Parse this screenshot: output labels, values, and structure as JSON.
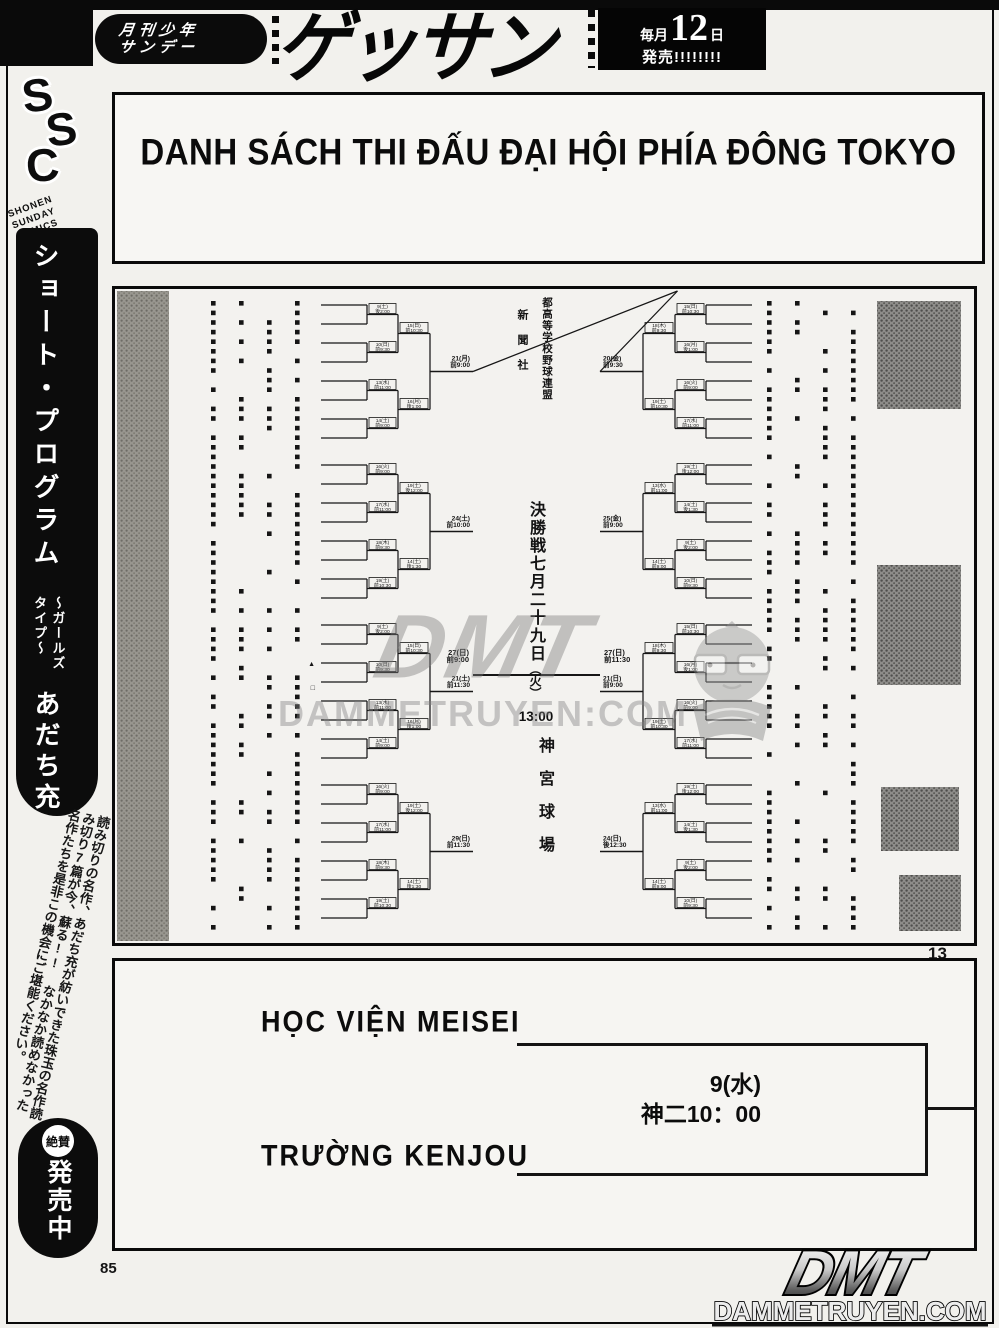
{
  "banner": {
    "magazine_line1": "月刊少年",
    "magazine_line2": "サンデー",
    "logo": "ゲッサン",
    "release_prefix": "毎月",
    "release_day": "12",
    "release_day_suffix": "日",
    "release_suffix": "発売!!!!!!!!"
  },
  "sidebar": {
    "logo_letters": [
      "S",
      "S",
      "C"
    ],
    "logo_caption": "SHONEN SUNDAY COMICS",
    "series_title": "ショート・プログラム",
    "series_subtitle": "〜ガールズタイプ〜",
    "author": "あだち充",
    "blurb": "読み切りの名作、あだち充が紡いできた珠玉の名作読み切り7篇が今、蘇る!! なかなか読めなかった名作たちを是非この機会にご堪能ください。",
    "badge": "絶賛",
    "on_sale": "発売中",
    "page_number": "85"
  },
  "title_box": {
    "title": "DANH SÁCH THI ĐẤU ĐẠI HỘI PHÍA ĐÔNG TOKYO"
  },
  "bracket": {
    "org_column_a": "新聞社",
    "org_column_b": "都高等学校野球連盟",
    "final_text": "決勝戦七月二十九日",
    "final_day": "（火）",
    "final_time": "13:00",
    "venue": "神宮球場",
    "page_number": "13",
    "left_semi_label": "27(日)\n前9:00",
    "right_semi_label": "27(日)\n前11:30",
    "left_tap_labels": [
      "21(月)\n前9:00",
      "24(土)\n前10:00",
      "21(土)\n前11:30",
      "29(日)\n前11:30"
    ],
    "right_tap_labels": [
      "20(金)\n前9:30",
      "25(金)\n前9:00",
      "21(日)\n前9:00",
      "24(日)\n後12:30"
    ],
    "small_label_pool": [
      "9(土)\n後2:00",
      "10(日)\n前9:30",
      "13(水)\n前11:00",
      "14(土)\n前9:00",
      "15(日)\n前10:30",
      "16(月)\n後1:00",
      "16(火)\n前9:00",
      "17(水)\n前11:00",
      "18(木)\n前9:30",
      "19(土)\n前10:30",
      "19(土)\n後12:00",
      "14(土)\n後1:30"
    ],
    "markers": [
      "▲",
      "□"
    ]
  },
  "watermark": {
    "logo": "DMT",
    "site": "DAMMETRUYEN:COM"
  },
  "next_match": {
    "team_top": "HỌC VIỆN MEISEI",
    "team_bottom": "TRƯỜNG KENJOU",
    "date": "9(水)",
    "time_venue": "神二10：00"
  },
  "footer_logo": {
    "logo": "DMT",
    "site": "DAMMETRUYEN.COM"
  }
}
